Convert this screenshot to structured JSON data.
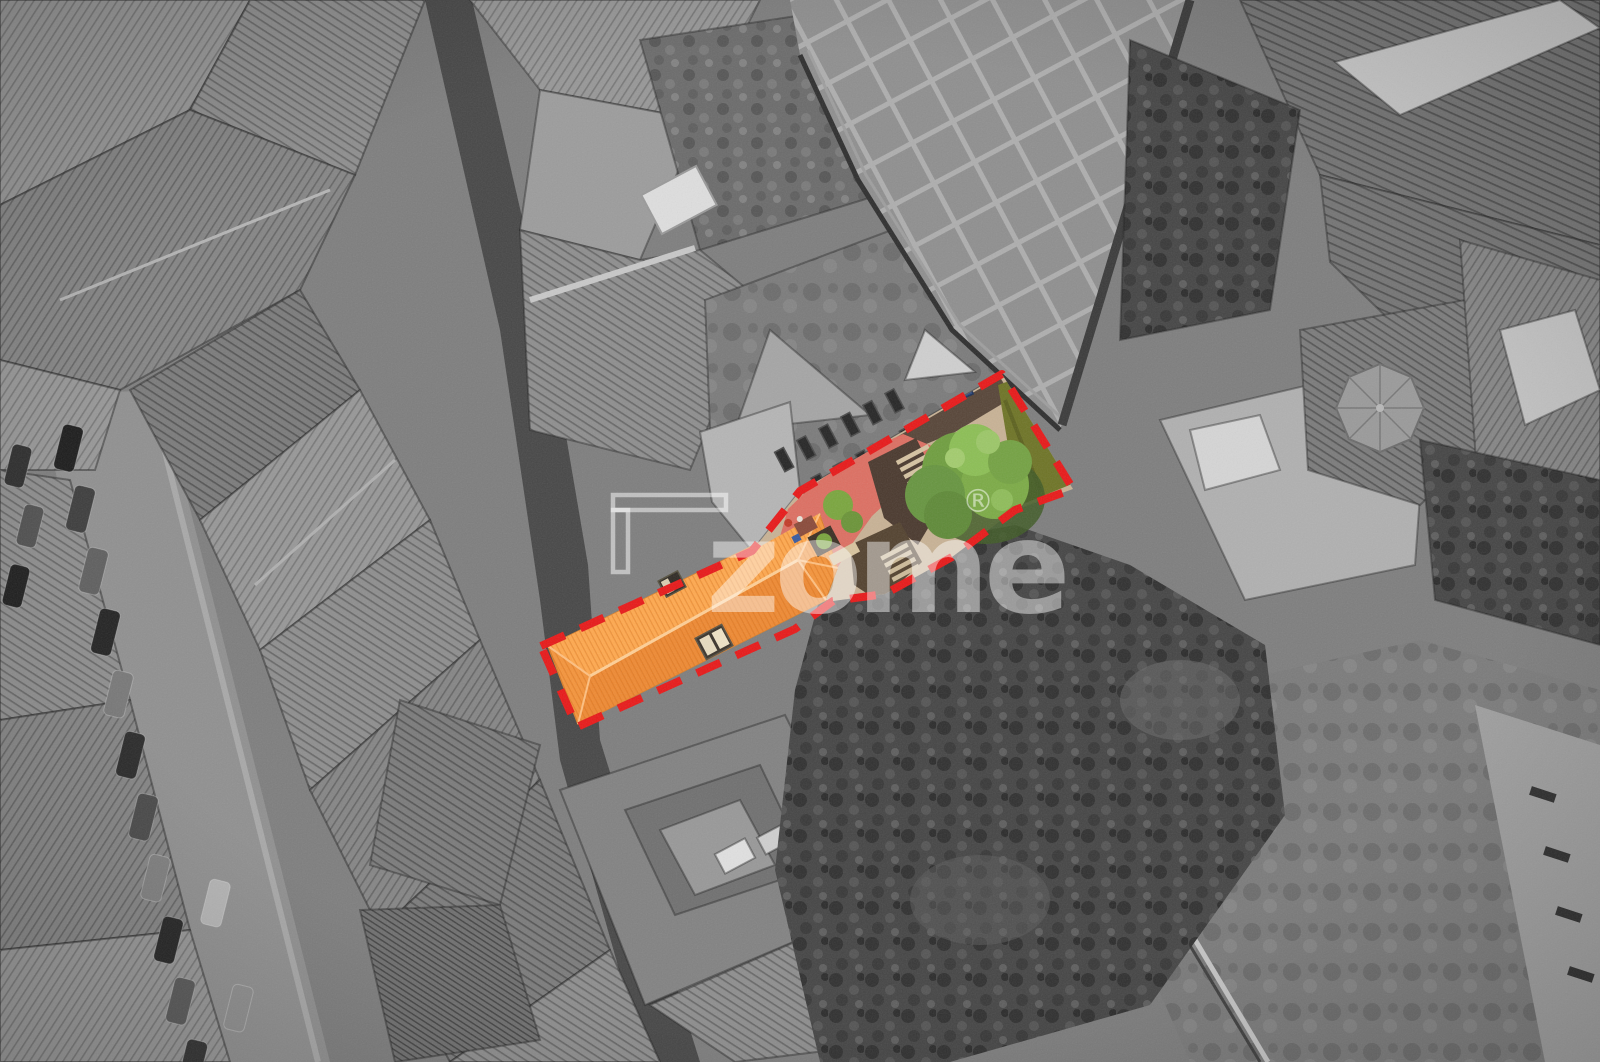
{
  "watermark": {
    "brand": "zome",
    "registered_symbol": "®"
  },
  "palette": {
    "boundary_red": "#e81919",
    "roof_orange": "#f5953c",
    "roof_orange_light": "#ffa94f",
    "roof_orange_dark": "#ef8a33",
    "roof_ridge": "#ffcf96",
    "patio_red": "#dd6f62",
    "path_tan": "#c8b295",
    "shadow_brown": "#4a392e",
    "tree_green": "#6f9e3f",
    "tree_green_light": "#8cbf55",
    "lawn_olive": "#6e7426",
    "watermark_white": "rgba(255,255,255,0.45)",
    "background_gray": "#7e7e7e"
  },
  "scene": {
    "landmarks": [
      "highlighted property parcel with red dashed boundary",
      "orange tiled roof with two skylights",
      "courtyard with red patio, tan terrace, stairs and large tree",
      "olive lawn strip at east end of parcel",
      "grayscale rooftops of surrounding city block",
      "gridded plaza at top",
      "octagonal tower roof at right",
      "street with parked cars at lower left",
      "dense vegetation behind the parcel"
    ]
  }
}
